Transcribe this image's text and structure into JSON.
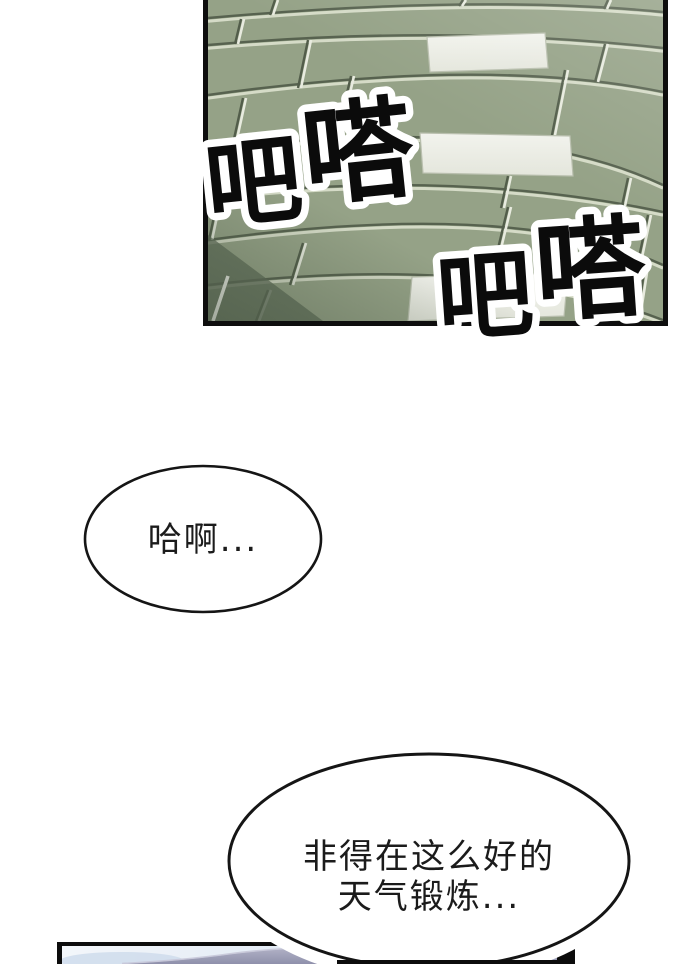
{
  "page": {
    "background": "#ffffff"
  },
  "top_panel": {
    "description": "green paving tiles in perspective",
    "sfx": [
      {
        "chars": [
          "吧",
          "嗒"
        ]
      },
      {
        "chars": [
          "吧",
          "嗒"
        ]
      }
    ],
    "colors": {
      "tile_green": "#95a287",
      "tile_green_dark": "#68755f",
      "tile_white": "#edeee7",
      "grout_dark": "#57624f",
      "grout_light": "#dde2cf"
    }
  },
  "speech_bubbles": [
    {
      "text": "哈啊..."
    },
    {
      "lines": [
        "非得在这么好的",
        "天气锻炼..."
      ]
    }
  ],
  "bottom_panel": {
    "description": "sky with purple hill, mostly cut off",
    "colors": {
      "sky_light": "#f3f6fa",
      "sky_blue": "#ccd8ea",
      "hill": "#8f90ab",
      "border": "#0c0c0c"
    }
  }
}
